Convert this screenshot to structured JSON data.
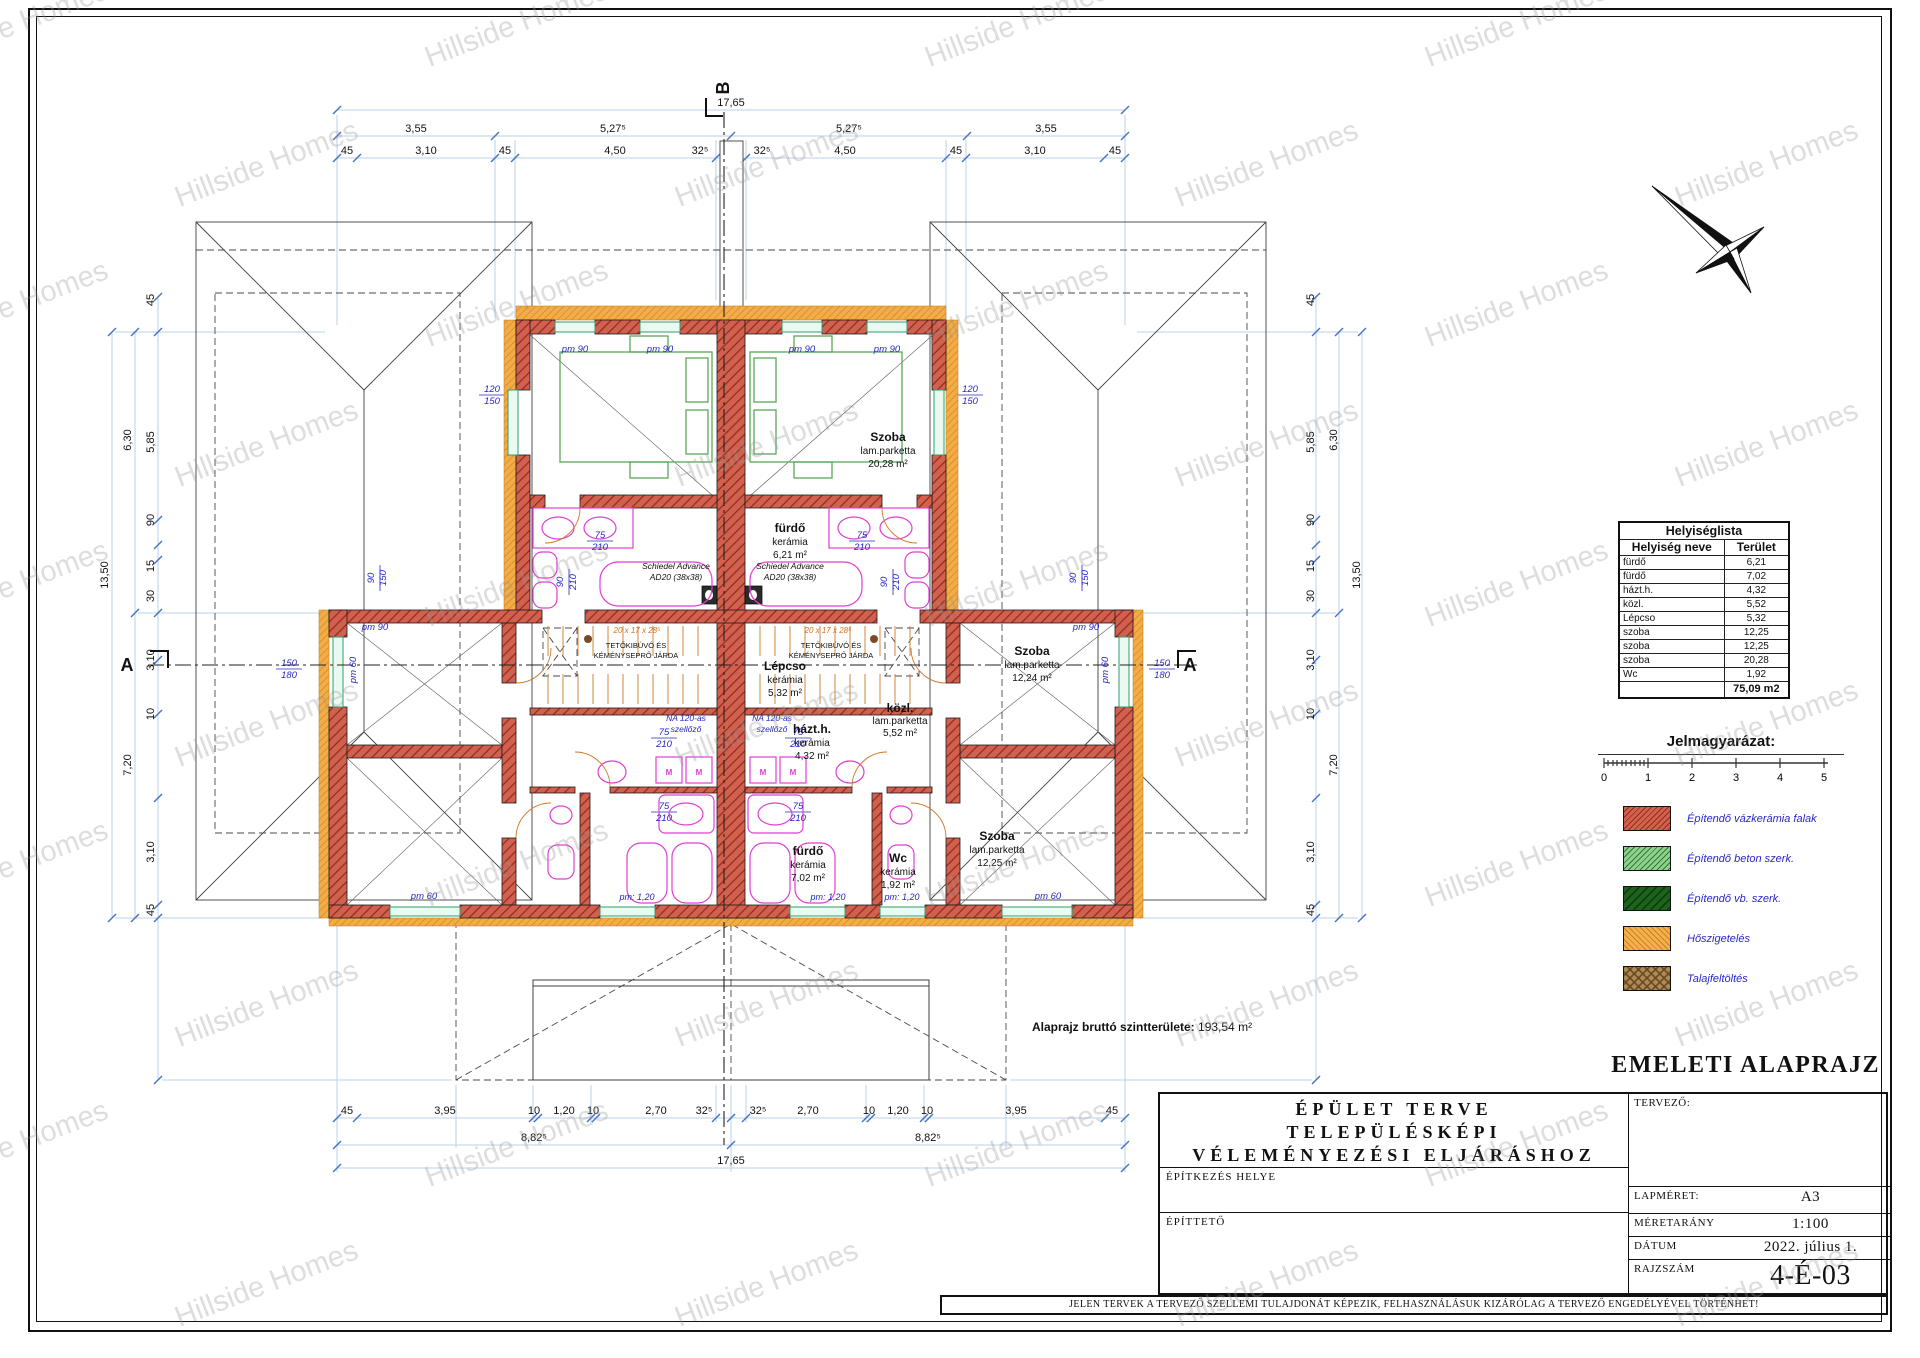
{
  "watermark": {
    "text": "Hillside Homes"
  },
  "drawing_title": "EMELETI ALAPRAJZ",
  "section": {
    "a": "A",
    "b": "B"
  },
  "gross": {
    "label": "Alaprajz bruttó szintterülete:",
    "value": "193,54 m²"
  },
  "plan": {
    "rooms": {
      "szoba_top": {
        "name": "Szoba",
        "finish": "lam.parketta",
        "area": "20,28 m²"
      },
      "furdo_top": {
        "name": "fürdő",
        "finish": "kerámia",
        "area": "6,21 m²"
      },
      "lepcso": {
        "name": "Lépcso",
        "finish": "kerámia",
        "area": "5,32 m²"
      },
      "kozl": {
        "name": "közl.",
        "finish": "lam.parketta",
        "area": "5,52 m²"
      },
      "hazth": {
        "name": "házt.h.",
        "finish": "kerámia",
        "area": "4,32 m²"
      },
      "szoba_mid": {
        "name": "Szoba",
        "finish": "lam.parketta",
        "area": "12,24 m²"
      },
      "szoba_bot": {
        "name": "Szoba",
        "finish": "lam.parketta",
        "area": "12,25 m²"
      },
      "furdo_bot": {
        "name": "fürdő",
        "finish": "kerámia",
        "area": "7,02 m²"
      },
      "wc": {
        "name": "Wc",
        "finish": "kerámia",
        "area": "1,92 m²"
      }
    },
    "annotations": {
      "schiedel1": "Schiedel Advance",
      "schiedel2": "AD20 (38x38)",
      "vent1": "NA 120-as",
      "vent2": "szellőző",
      "attic1": "TETŐKIBÚVÓ ÉS",
      "attic2": "KÉMÉNYSEPRŐ JÁRDA",
      "stair": "20 x 17 x 28⁵",
      "m": "M"
    }
  },
  "dims": {
    "top1": "17,65",
    "top2": [
      "3,55",
      "5,27⁵",
      "5,27⁵",
      "3,55"
    ],
    "top3": [
      "45",
      "3,10",
      "45",
      "4,50",
      "32⁵",
      "32⁵",
      "4,50",
      "45",
      "3,10",
      "45"
    ],
    "bot1": [
      "45",
      "3,95",
      "10",
      "1,20",
      "10",
      "2,70",
      "32⁵",
      "32⁵",
      "2,70",
      "10",
      "1,20",
      "10",
      "3,95",
      "45"
    ],
    "bot2": [
      "8,82⁵",
      "8,82⁵"
    ],
    "bot3": "17,65",
    "side": {
      "total": "13,50",
      "v630": "6,30",
      "v585": "5,85",
      "v720": "7,20",
      "v310": "3,10",
      "v45": "45",
      "v90": "90",
      "v15": "15",
      "v30": "30",
      "v10": "10"
    },
    "blue": {
      "pm90": "pm 90",
      "pm60": "pm 60",
      "pm120": "pm: 1,20",
      "n75": "75",
      "n210": "210",
      "n90": "90",
      "n120": "120",
      "n150": "150",
      "n180": "180"
    }
  },
  "room_list": {
    "title": "Helyiséglista",
    "col1": "Helyiség neve",
    "col2": "Terület",
    "rows": [
      [
        "fürdő",
        "6,21"
      ],
      [
        "fürdő",
        "7,02"
      ],
      [
        "házt.h.",
        "4,32"
      ],
      [
        "közl.",
        "5,52"
      ],
      [
        "Lépcso",
        "5,32"
      ],
      [
        "szoba",
        "12,25"
      ],
      [
        "szoba",
        "12,25"
      ],
      [
        "szoba",
        "20,28"
      ],
      [
        "Wc",
        "1,92"
      ]
    ],
    "total": "75,09 m2"
  },
  "legend": {
    "title": "Jelmagyarázat:",
    "scale": [
      "0",
      "1",
      "2",
      "3",
      "4",
      "5"
    ],
    "items": [
      {
        "label": "Építendő vázkerámia falak"
      },
      {
        "label": "Építendő beton szerk."
      },
      {
        "label": "Építendő vb. szerk."
      },
      {
        "label": "Hőszigetelés"
      },
      {
        "label": "Talajfeltöltés"
      }
    ]
  },
  "titleblock": {
    "line1": "ÉPÜLET TERVE",
    "line2": "TELEPÜLÉSKÉPI",
    "line3": "VÉLEMÉNYEZÉSI ELJÁRÁSHOZ",
    "site": "ÉPÍTKEZÉS HELYE",
    "client": "ÉPÍTTETŐ",
    "designer": "TERVEZŐ:",
    "size_label": "LAPMÉRET:",
    "size": "A3",
    "scale_label": "MÉRETARÁNY",
    "scale": "1:100",
    "date_label": "DÁTUM",
    "date": "2022. július 1.",
    "no_label": "RAJZSZÁM",
    "no": "4-É-03",
    "disclaimer": "JELEN TERVEK A TERVEZŐ SZELLEMI TULAJDONÁT KÉPEZIK, FELHASZNÁLÁSUK KIZÁRÓLAG A TERVEZŐ ENGEDÉLYÉVEL TÖRTÉNHET!"
  },
  "colors": {
    "wall": "#d2604e",
    "wall_hatch": "#8f2a1e",
    "insulation": "#f3ac46",
    "fixture": "#e13ed4",
    "bed": "#5aa85a",
    "dim_line": "#b9d3ea",
    "dim_tick": "#4472c4",
    "blue_label": "#2727c4"
  }
}
